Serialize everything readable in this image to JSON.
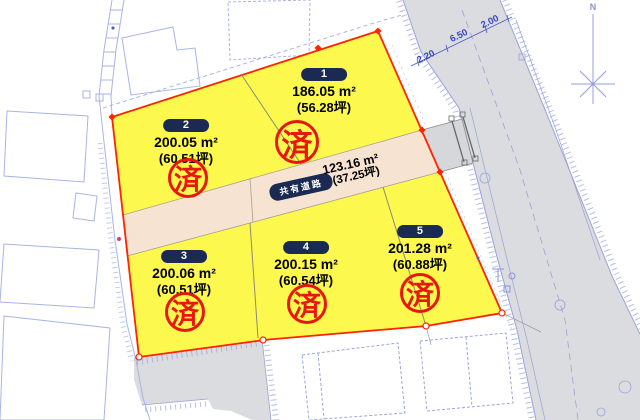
{
  "compass": {
    "north_label": "N"
  },
  "main_road": {
    "width_dimensions": [
      "2.20",
      "6.50",
      "2.00"
    ]
  },
  "shared_road": {
    "name": "共有道路",
    "area_m2": "123.16 m²",
    "area_tsubo": "(37.25坪)"
  },
  "lots": [
    {
      "number": "1",
      "area_m2": "186.05 m²",
      "area_tsubo": "(56.28坪)",
      "status_stamp": "済"
    },
    {
      "number": "2",
      "area_m2": "200.05 m²",
      "area_tsubo": "(60.51坪)",
      "status_stamp": "済"
    },
    {
      "number": "3",
      "area_m2": "200.06 m²",
      "area_tsubo": "(60.51坪)",
      "status_stamp": "済"
    },
    {
      "number": "4",
      "area_m2": "200.15 m²",
      "area_tsubo": "(60.54坪)",
      "status_stamp": "済"
    },
    {
      "number": "5",
      "area_m2": "201.28 m²",
      "area_tsubo": "(60.88坪)",
      "status_stamp": "済"
    }
  ],
  "colors": {
    "lot_fill": "#fdf84e",
    "lot_boundary": "#ff2300",
    "shared_road_fill": "#f7e3d1",
    "road_fill": "#dbdcdf",
    "stamp_red": "#e8170b",
    "label_pill_navy": "#1b2a52",
    "survey_line_blue": "#9aa6dd",
    "dimension_text_blue": "#3a46c8"
  }
}
